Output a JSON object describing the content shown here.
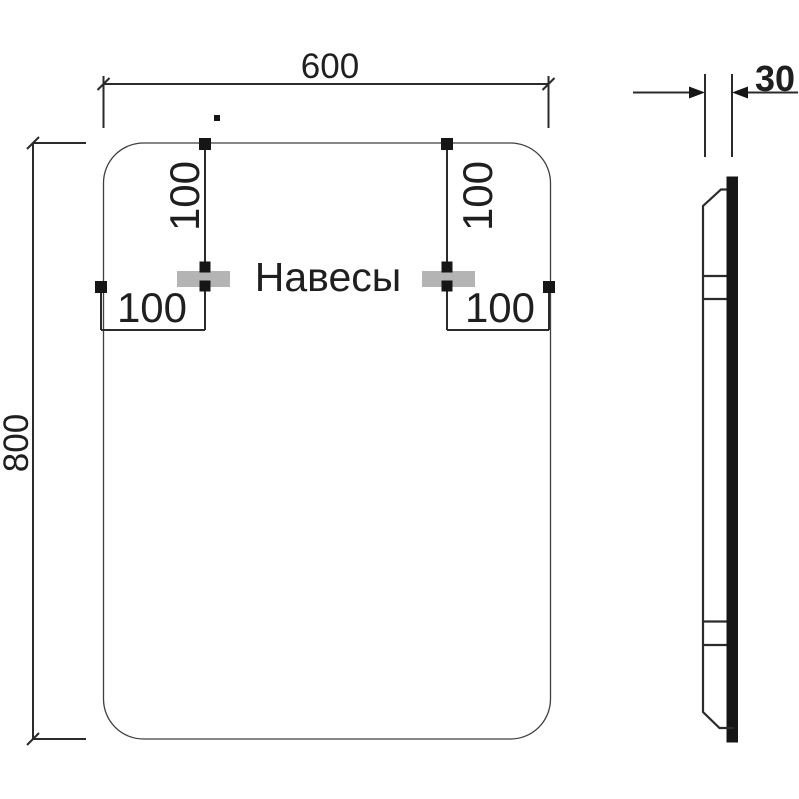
{
  "front_view": {
    "width_label": "600",
    "height_label": "800",
    "hangers_label": "Навесы",
    "left_hanger_top_offset": "100",
    "right_hanger_top_offset": "100",
    "left_hanger_side_offset": "100",
    "right_hanger_side_offset": "100"
  },
  "side_view": {
    "depth_label": "30"
  },
  "colors": {
    "line": "#2b2b2b",
    "outline": "#3f3f3f",
    "text": "#1f1f1f",
    "solid": "#161616",
    "hanger_fill": "#b4b4b4"
  }
}
